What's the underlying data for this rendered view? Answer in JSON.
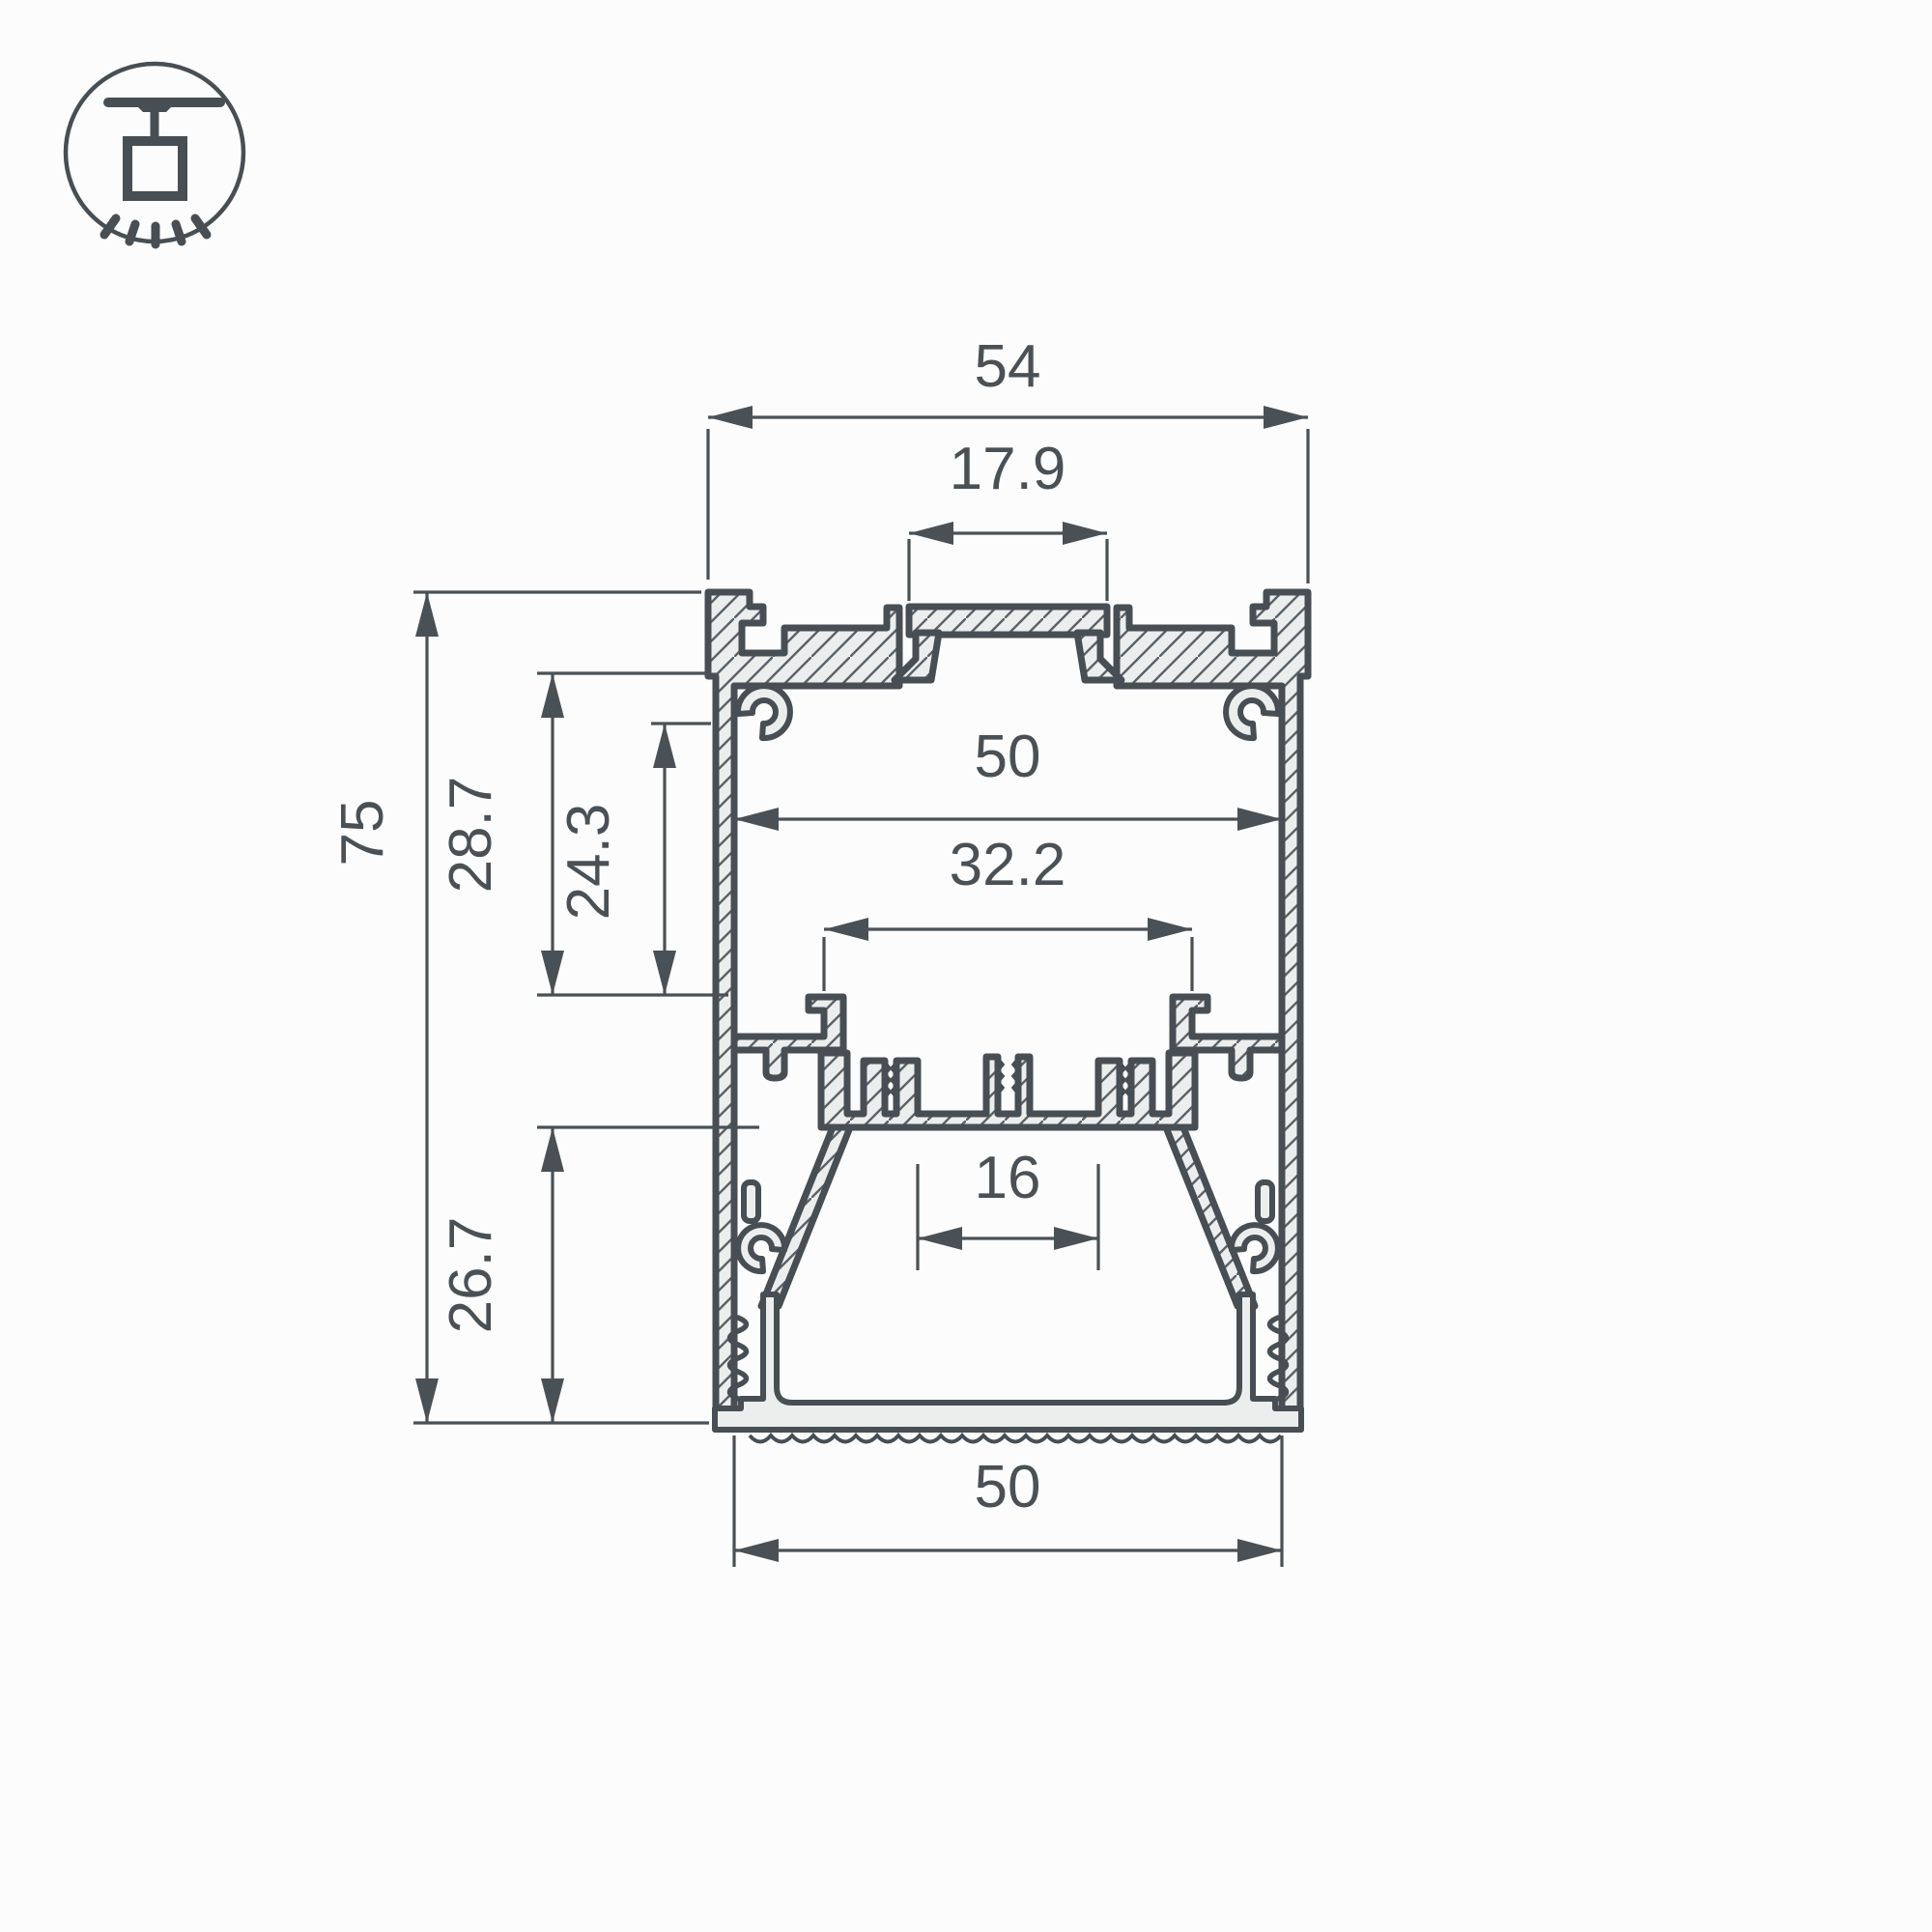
{
  "icon": {
    "name": "suspended-luminaire-mount-icon"
  },
  "drawing": {
    "title": "LED profile cross-section",
    "dimensions": {
      "top_width": "54",
      "top_slot_width": "17.9",
      "inner_width": "50",
      "ledge_opening_width": "32.2",
      "led_channel_width": "16",
      "bottom_cover_width": "50",
      "overall_height": "75",
      "upper_cavity_depth": "28.7",
      "inner_cavity_depth": "24.3",
      "lower_cavity_depth": "26.7"
    },
    "colors": {
      "outline": "#474e54",
      "dimension": "#4a5156",
      "metal_fill": "#eceeed",
      "background": "#fcfcfc"
    }
  }
}
